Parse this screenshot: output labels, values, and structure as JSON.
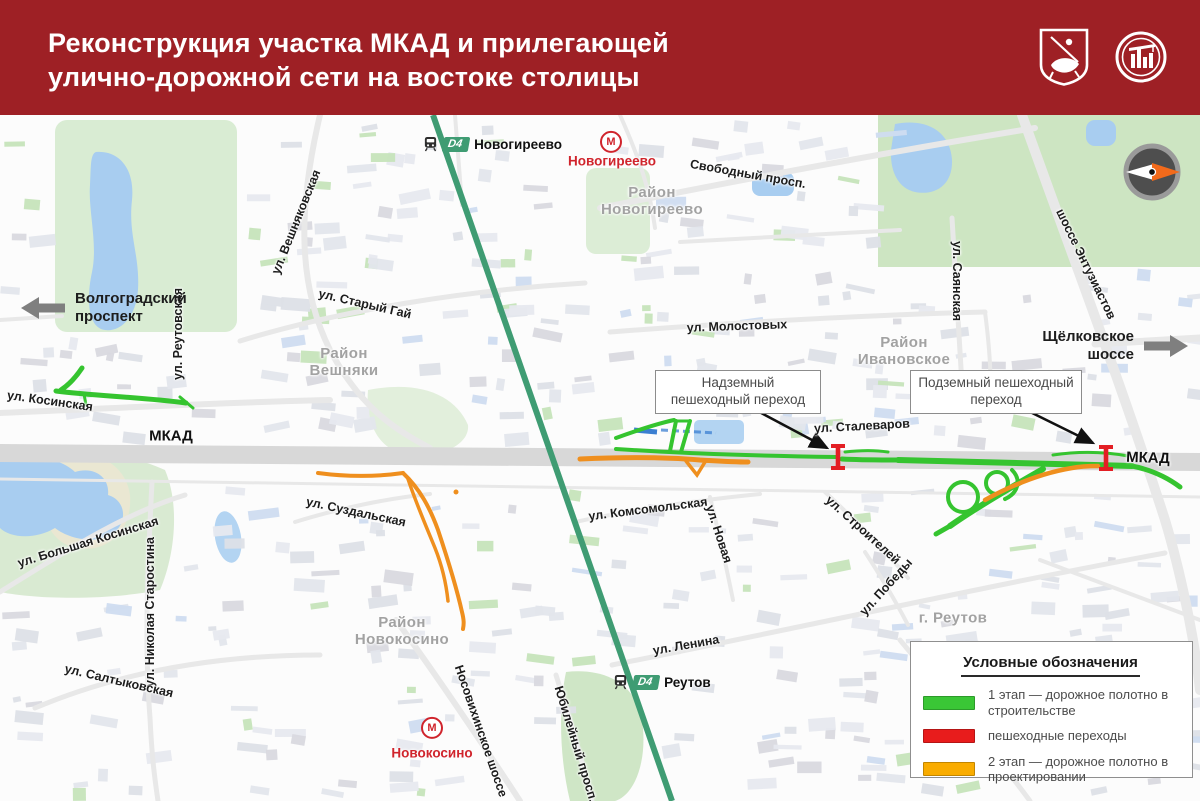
{
  "header": {
    "title_line1": "Реконструкция участка МКАД и прилегающей",
    "title_line2": "улично-дорожной сети на востоке столицы",
    "logos": [
      "moscow-coat-of-arms",
      "moscow-building-complex"
    ]
  },
  "colors": {
    "header_red": "#9e2025",
    "stage1_green": "#35c42f",
    "crossing_red": "#e31e24",
    "stage2_orange": "#ef8f1e",
    "rail_green": "#3f9c73",
    "metro_red": "#d0242c"
  },
  "map": {
    "labels": [
      {
        "text": "ул. Вешняковская",
        "x": 296,
        "y": 222,
        "rot": -68,
        "cls": "street"
      },
      {
        "text": "ул. Старый Гай",
        "x": 365,
        "y": 304,
        "rot": 13,
        "cls": "street"
      },
      {
        "text": "Свободный просп.",
        "x": 748,
        "y": 174,
        "rot": 10,
        "cls": "street"
      },
      {
        "text": "ул. Молостовых",
        "x": 737,
        "y": 326,
        "rot": -2,
        "cls": "street"
      },
      {
        "text": "ул. Саянская",
        "x": 957,
        "y": 281,
        "rot": 90,
        "cls": "street"
      },
      {
        "text": "шоссе Энтузиастов",
        "x": 1086,
        "y": 264,
        "rot": 64,
        "cls": "street"
      },
      {
        "text": "ул. Косинская",
        "x": 50,
        "y": 401,
        "rot": 8,
        "cls": "street"
      },
      {
        "text": "ул. Реутовская",
        "x": 178,
        "y": 334,
        "rot": -90,
        "cls": "street"
      },
      {
        "text": "ул. Сталеваров",
        "x": 862,
        "y": 426,
        "rot": -3,
        "cls": "street"
      },
      {
        "text": "ул. Комсомольская",
        "x": 648,
        "y": 509,
        "rot": -7,
        "cls": "street"
      },
      {
        "text": "ул. Новая",
        "x": 719,
        "y": 534,
        "rot": 72,
        "cls": "street"
      },
      {
        "text": "ул. Строителей",
        "x": 863,
        "y": 530,
        "rot": 42,
        "cls": "street"
      },
      {
        "text": "ул. Победы",
        "x": 886,
        "y": 587,
        "rot": -48,
        "cls": "street"
      },
      {
        "text": "ул. Ленина",
        "x": 686,
        "y": 645,
        "rot": -10,
        "cls": "street"
      },
      {
        "text": "ул. Большая Косинская",
        "x": 88,
        "y": 542,
        "rot": -17,
        "cls": "street"
      },
      {
        "text": "ул. Николая Старостина",
        "x": 150,
        "y": 612,
        "rot": -90,
        "cls": "street"
      },
      {
        "text": "ул. Салтыковская",
        "x": 119,
        "y": 681,
        "rot": 13,
        "cls": "street"
      },
      {
        "text": "ул. Суздальская",
        "x": 356,
        "y": 512,
        "rot": 12,
        "cls": "street"
      },
      {
        "text": "Носовихинское шоссе",
        "x": 481,
        "y": 731,
        "rot": 71,
        "cls": "street"
      },
      {
        "text": "Юбилейный просп.",
        "x": 576,
        "y": 744,
        "rot": 73,
        "cls": "street"
      },
      {
        "text": "МКАД",
        "x": 171,
        "y": 436,
        "rot": 0,
        "cls": "mkad"
      },
      {
        "text": "МКАД",
        "x": 1148,
        "y": 458,
        "rot": 2,
        "cls": "mkad"
      },
      {
        "text": "Район\nНовогиреево",
        "x": 652,
        "y": 201,
        "rot": 0,
        "cls": "district"
      },
      {
        "text": "Район\nВешняки",
        "x": 344,
        "y": 362,
        "rot": 0,
        "cls": "district"
      },
      {
        "text": "Район\nИвановское",
        "x": 904,
        "y": 351,
        "rot": 0,
        "cls": "district"
      },
      {
        "text": "Район\nНовокосино",
        "x": 402,
        "y": 631,
        "rot": 0,
        "cls": "district"
      },
      {
        "text": "г. Реутов",
        "x": 953,
        "y": 618,
        "rot": 0,
        "cls": "district"
      }
    ],
    "d4_stations": [
      {
        "badge": "D4",
        "name": "Новогиреево",
        "x": 423,
        "y": 144
      },
      {
        "badge": "D4",
        "name": "Реутов",
        "x": 613,
        "y": 682
      }
    ],
    "metro_letter": "М",
    "metro_stations": [
      {
        "name": "Новогиреево",
        "x": 611,
        "y": 143,
        "label_x": 612,
        "label_y": 161
      },
      {
        "name": "Новокосино",
        "x": 432,
        "y": 729,
        "label_x": 432,
        "label_y": 753
      }
    ],
    "callouts": [
      {
        "text": "Надземный пешеходный переход"
      },
      {
        "text": "Подземный пешеходный переход"
      }
    ],
    "direction_arrows": [
      {
        "text": "Волгоградский проспект",
        "dir": "left"
      },
      {
        "text": "Щёлковское шоссе",
        "dir": "right"
      }
    ]
  },
  "legend": {
    "title": "Условные обозначения",
    "items": [
      {
        "color": "#3ac636",
        "label": "1 этап — дорожное полотно в строительстве"
      },
      {
        "color": "#e81c1c",
        "label": "пешеходные переходы"
      },
      {
        "color": "#f9ac00",
        "label": "2 этап — дорожное полотно в проектировании"
      }
    ]
  }
}
